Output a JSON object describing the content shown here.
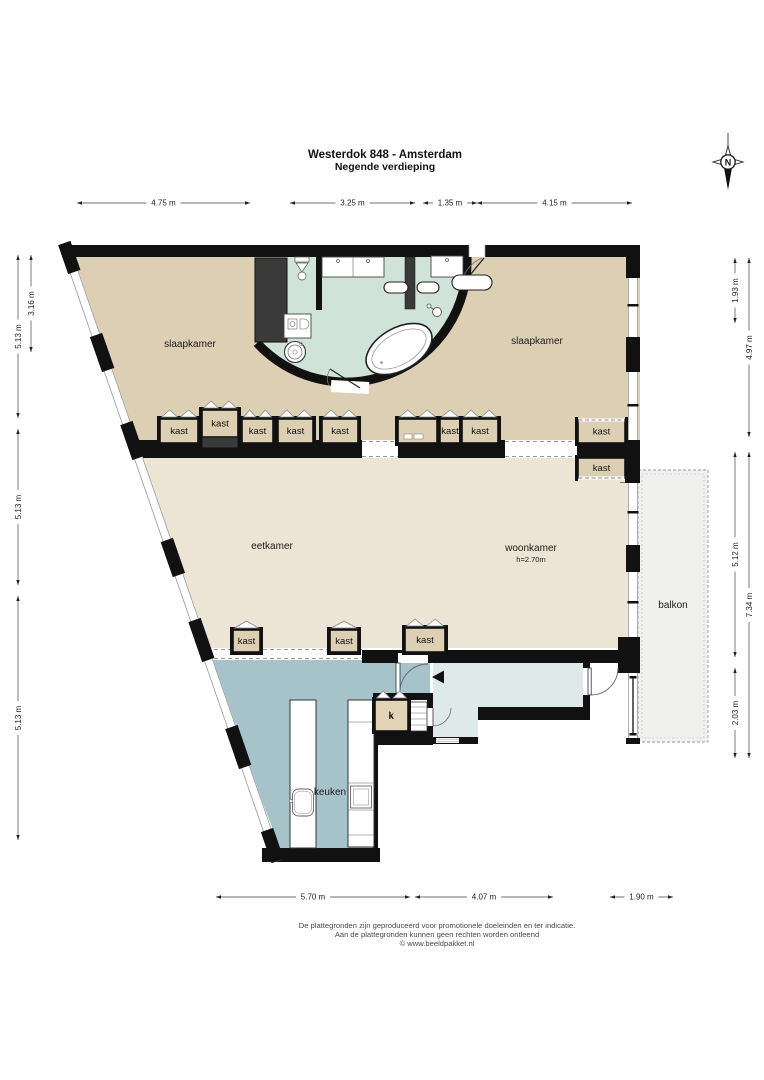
{
  "title": {
    "line1": "Westerdok 848 - Amsterdam",
    "line2": "Negende verdieping"
  },
  "compass": {
    "north_label": "N"
  },
  "rooms": [
    {
      "name": "slaapkamer-left",
      "label": "slaapkamer",
      "x": 190,
      "y": 347
    },
    {
      "name": "slaapkamer-right",
      "label": "slaapkamer",
      "x": 537,
      "y": 344
    },
    {
      "name": "eetkamer",
      "label": "eetkamer",
      "x": 272,
      "y": 549
    },
    {
      "name": "woonkamer",
      "label": "woonkamer",
      "x": 531,
      "y": 551,
      "sub": "h=2.70m",
      "subx": 531,
      "suby": 562
    },
    {
      "name": "balkon",
      "label": "balkon",
      "x": 673,
      "y": 608
    },
    {
      "name": "keuken",
      "label": "keuken",
      "x": 330,
      "y": 795
    },
    {
      "name": "k-closet",
      "label": "k",
      "x": 391,
      "y": 719
    }
  ],
  "closets": [
    {
      "label": "kast",
      "x": 160,
      "y": 419,
      "w": 38,
      "h": 24,
      "doors": 2
    },
    {
      "label": "kast",
      "x": 202,
      "y": 410,
      "w": 36,
      "h": 27,
      "doors": 2,
      "dark_strip": true
    },
    {
      "label": "kast",
      "x": 242,
      "y": 419,
      "w": 31,
      "h": 24,
      "doors": 2
    },
    {
      "label": "kast",
      "x": 278,
      "y": 419,
      "w": 35,
      "h": 24,
      "doors": 2
    },
    {
      "label": "kast",
      "x": 322,
      "y": 419,
      "w": 36,
      "h": 24,
      "doors": 2
    },
    {
      "label": "",
      "x": 398,
      "y": 419,
      "w": 39,
      "h": 24,
      "doors": 2,
      "detail": "squares"
    },
    {
      "label": "kast",
      "x": 440,
      "y": 419,
      "w": 20,
      "h": 24,
      "doors": 1
    },
    {
      "label": "kast",
      "x": 462,
      "y": 419,
      "w": 36,
      "h": 24,
      "doors": 2
    },
    {
      "label": "kast",
      "x": 578,
      "y": 420,
      "w": 47,
      "h": 23,
      "doors": 0,
      "dash": "top",
      "dash_bg": "bedroom"
    },
    {
      "label": "kast",
      "x": 578,
      "y": 458,
      "w": 47,
      "h": 20,
      "doors": 0,
      "dash": "bottom",
      "dash_bg": "living"
    },
    {
      "label": "kast",
      "x": 233,
      "y": 630,
      "w": 27,
      "h": 22,
      "doors": 1
    },
    {
      "label": "kast",
      "x": 330,
      "y": 630,
      "w": 28,
      "h": 22,
      "doors": 1
    },
    {
      "label": "kast",
      "x": 405,
      "y": 628,
      "w": 40,
      "h": 24,
      "doors": 2
    },
    {
      "label": "k",
      "x": 375,
      "y": 700,
      "w": 33,
      "h": 31,
      "doors": 2,
      "fill": "k"
    }
  ],
  "dimensions": [
    {
      "o": "h",
      "label": "4.75 m",
      "a": 77,
      "b": 250,
      "p": 203
    },
    {
      "o": "h",
      "label": "3.25 m",
      "a": 290,
      "b": 415,
      "p": 203
    },
    {
      "o": "h",
      "label": "1.35 m",
      "a": 423,
      "b": 477,
      "p": 203
    },
    {
      "o": "h",
      "label": "4.15 m",
      "a": 477,
      "b": 632,
      "p": 203
    },
    {
      "o": "v",
      "label": "5.13 m",
      "a": 255,
      "b": 418,
      "p": 18
    },
    {
      "o": "v",
      "label": "5.13 m",
      "a": 429,
      "b": 585,
      "p": 18
    },
    {
      "o": "v",
      "label": "5.13 m",
      "a": 596,
      "b": 840,
      "p": 18
    },
    {
      "o": "v",
      "label": "3.16 m",
      "a": 255,
      "b": 352,
      "p": 31
    },
    {
      "o": "v",
      "label": "1.93 m",
      "a": 258,
      "b": 323,
      "p": 735
    },
    {
      "o": "v",
      "label": "5.12 m",
      "a": 452,
      "b": 657,
      "p": 735
    },
    {
      "o": "v",
      "label": "2.03 m",
      "a": 668,
      "b": 758,
      "p": 735
    },
    {
      "o": "v",
      "label": "4.97 m",
      "a": 258,
      "b": 437,
      "p": 749
    },
    {
      "o": "v",
      "label": "7.34 m",
      "a": 452,
      "b": 758,
      "p": 749
    },
    {
      "o": "h",
      "label": "5.70 m",
      "a": 216,
      "b": 410,
      "p": 897
    },
    {
      "o": "h",
      "label": "4.07 m",
      "a": 415,
      "b": 553,
      "p": 897
    },
    {
      "o": "h",
      "label": "1.90 m",
      "a": 610,
      "b": 673,
      "p": 897
    }
  ],
  "footer": {
    "line1": "De plattegronden zijn geproduceerd voor promotionele doeleinden en ter indicatie.",
    "line2": "Aan de plattegronden kunnen geen rechten worden ontleend",
    "line3": "© www.beeldpakket.nl"
  },
  "colors": {
    "wall": "#111111",
    "bedroom": "#dccfb3",
    "living": "#ece4d4",
    "bath": "#cfe3d9",
    "kitchen": "#a6c3ca",
    "hall": "#dfe9ea",
    "balcony": "#f0f0ee",
    "closet_dark": "#3a3a3a",
    "kast": "#dccfb3",
    "k": "#e3d3b6"
  }
}
